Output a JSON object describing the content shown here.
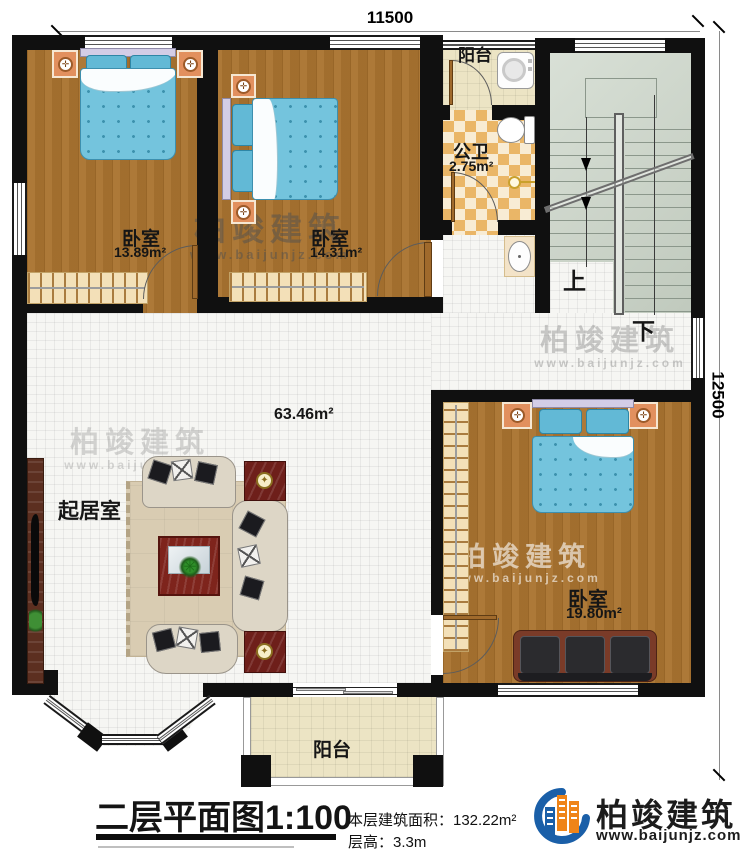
{
  "dimensions": {
    "top": "11500",
    "right": "12500"
  },
  "rooms": {
    "bedroom1": {
      "name": "卧室",
      "area": "13.89m²"
    },
    "bedroom2": {
      "name": "卧室",
      "area": "14.31m²"
    },
    "bedroom3": {
      "name": "卧室",
      "area": "19.80m²"
    },
    "bathroom": {
      "name": "公卫",
      "area": "2.75m²"
    },
    "living": {
      "name": "起居室",
      "area": "63.46m²"
    },
    "balcony_top": {
      "name": "阳台"
    },
    "balcony_bottom": {
      "name": "阳台"
    }
  },
  "stairs": {
    "up": "上",
    "down": "下"
  },
  "titleblock": {
    "title": "二层平面图",
    "scale": "1:100",
    "area_line": "本层建筑面积：132.22m²",
    "height_line": "层高：3.3m"
  },
  "brand": {
    "name": "柏竣建筑",
    "url": "www.baijunjz.com"
  },
  "watermark": {
    "name": "柏竣建筑",
    "url": "www.baijunjz.com"
  },
  "colors": {
    "wall": "#101010",
    "wood": "#aa7430",
    "bed": "#74c4dd",
    "bath_checker": "#eab667",
    "stairs": "#ccd6c9",
    "balcony": "#ece4c4",
    "nightstand": "#e2905e",
    "logo_blue": "#1a5fa8",
    "logo_orange": "#ef8418"
  }
}
